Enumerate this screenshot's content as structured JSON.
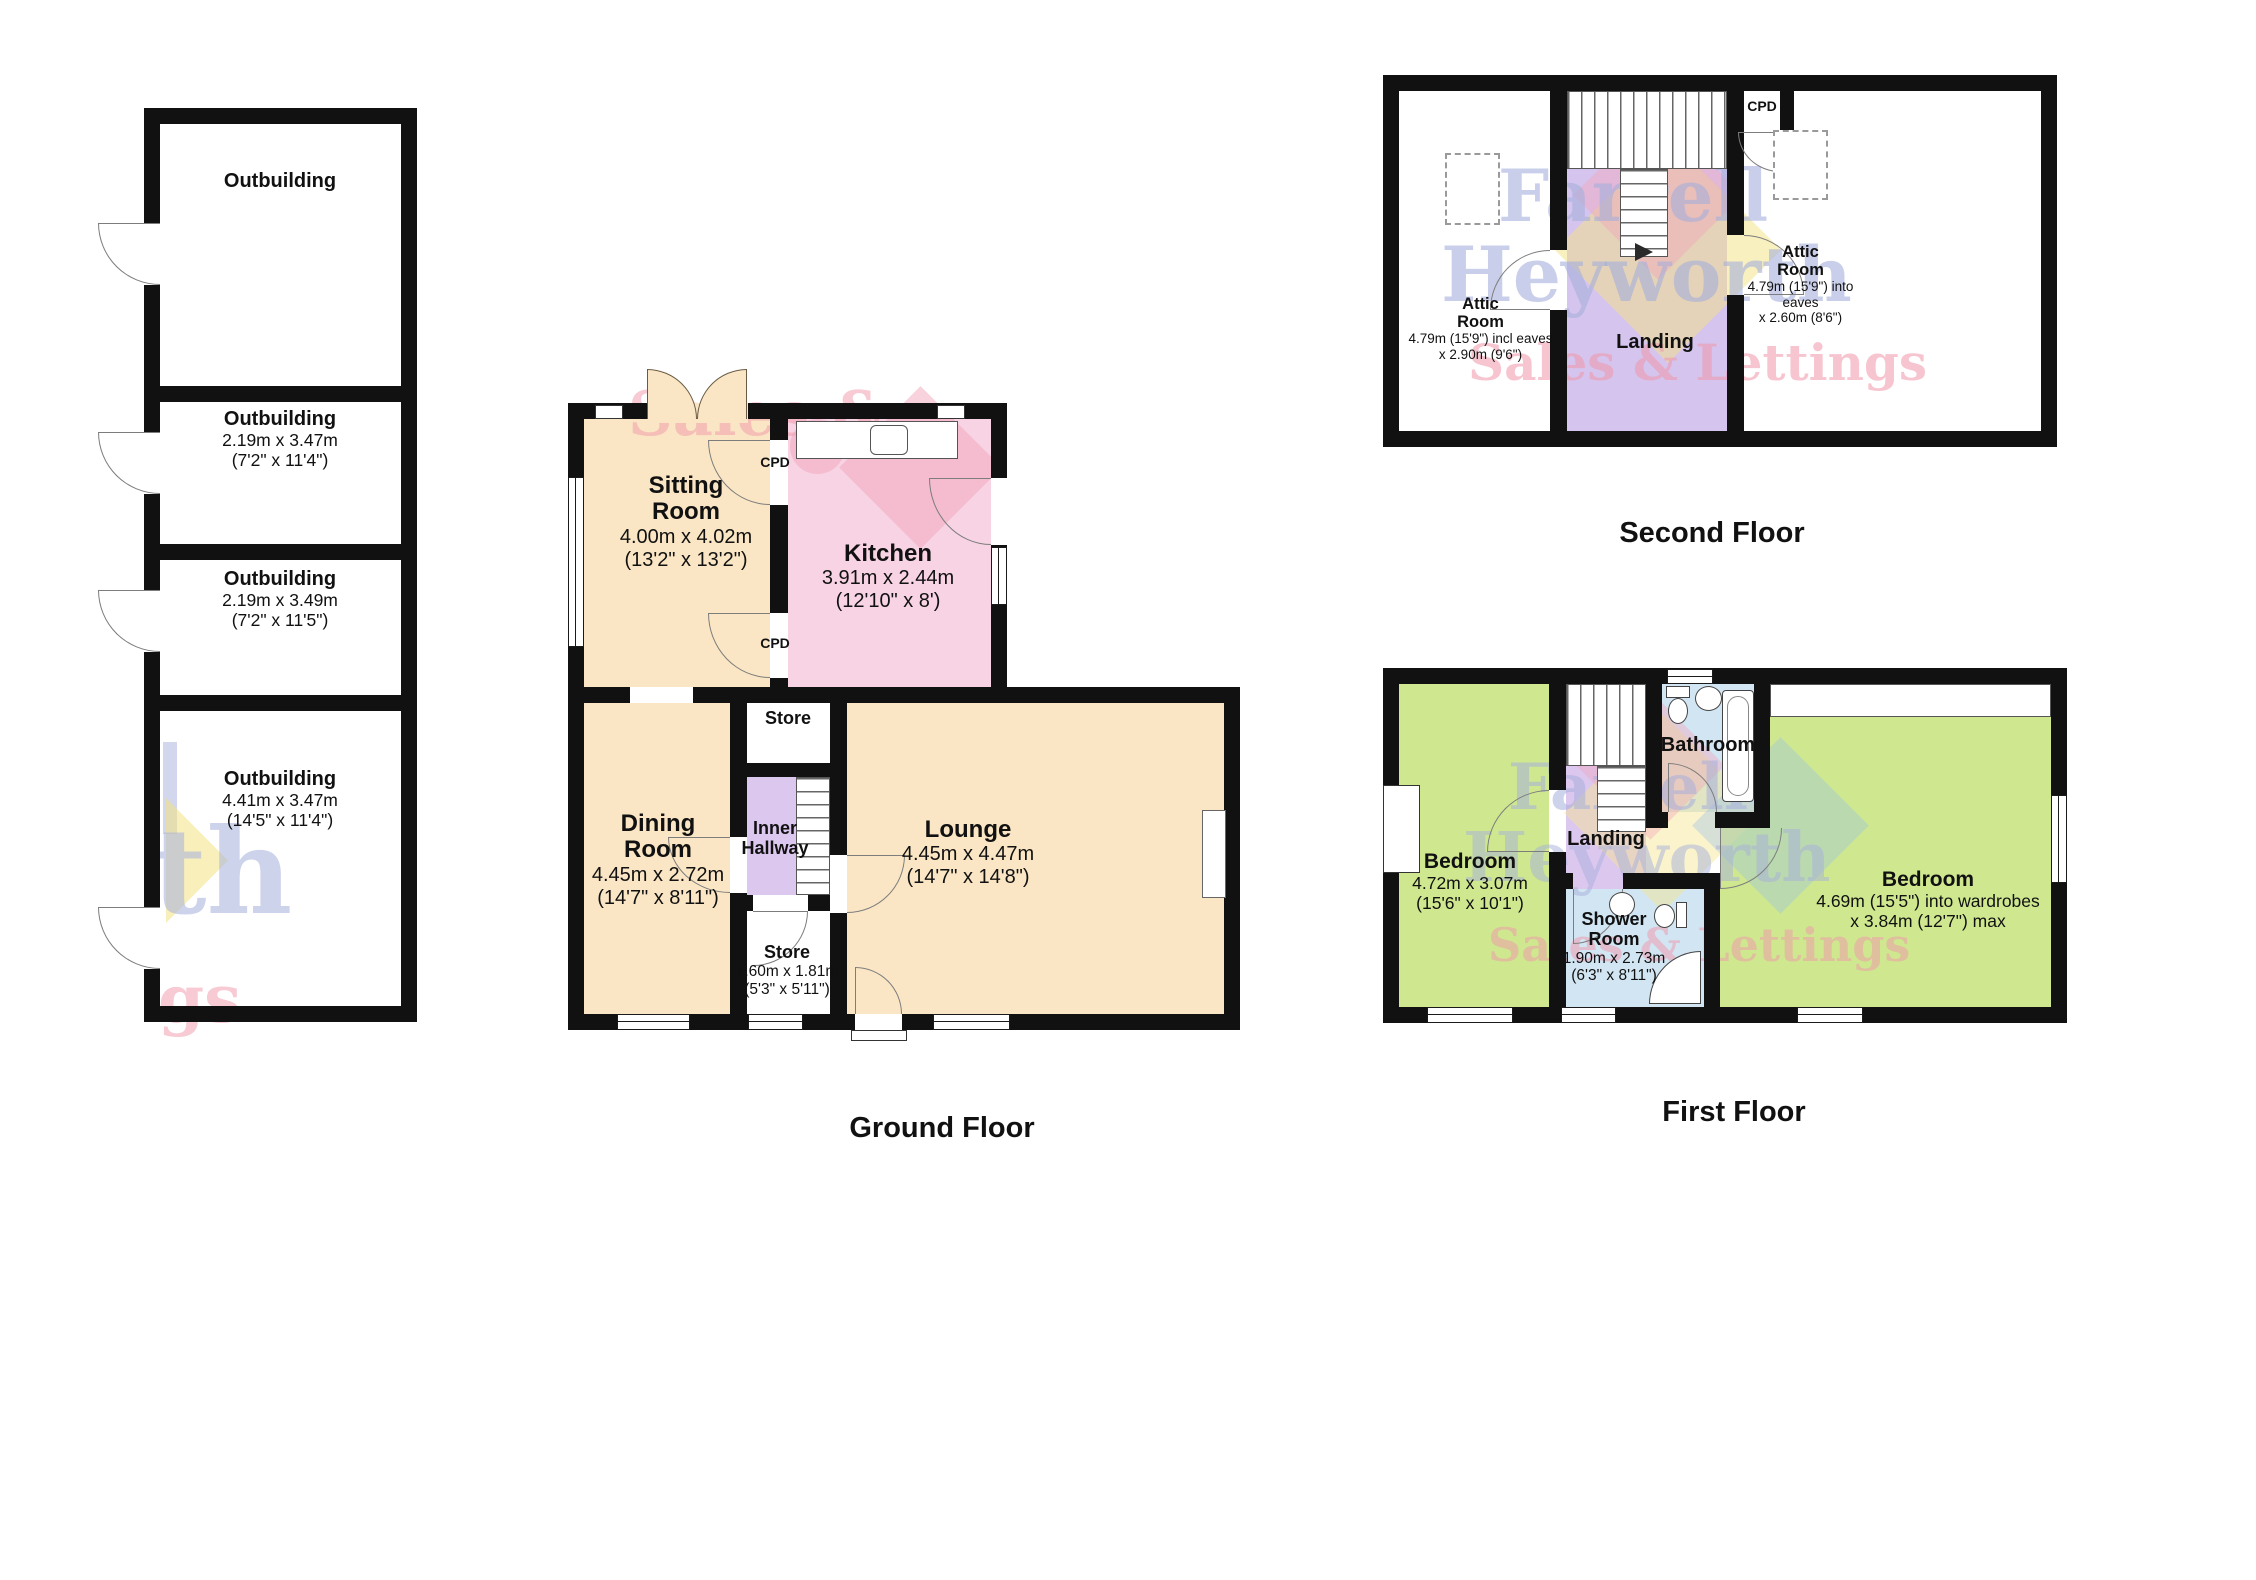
{
  "page": {
    "background": "#ffffff"
  },
  "titles": {
    "ground_floor": "Ground Floor",
    "first_floor": "First Floor",
    "second_floor": "Second Floor"
  },
  "watermark": {
    "farrell": "Farrell",
    "heyworth": "Heyworth",
    "sales_lettings": "Sales & Lettings",
    "frag_sales": "Sales &",
    "frag_th": "th",
    "frag_gs": "gs"
  },
  "colors": {
    "wall": "#111111",
    "room_peach": "#fae6c4",
    "room_pink": "#f7d3e3",
    "room_purple": "#dcc7ee",
    "room_green": "#cfe890",
    "room_blue": "#d2e5f2",
    "watermark_blue": "#a5afdc",
    "watermark_pink": "#f096aa",
    "watermark_yellow": "#f3e182"
  },
  "outbuildings": {
    "rooms": [
      {
        "name": "Outbuilding",
        "dims": ""
      },
      {
        "name": "Outbuilding",
        "dims": "2.19m x 3.47m\n(7'2\" x 11'4\")"
      },
      {
        "name": "Outbuilding",
        "dims": "2.19m x 3.49m\n(7'2\" x 11'5\")"
      },
      {
        "name": "Outbuilding",
        "dims": "4.41m x 3.47m\n(14'5\" x 11'4\")"
      }
    ]
  },
  "ground_floor": {
    "sitting_room": {
      "name": "Sitting\nRoom",
      "dims": "4.00m x 4.02m\n(13'2\" x 13'2\")"
    },
    "kitchen": {
      "name": "Kitchen",
      "dims": "3.91m x 2.44m\n(12'10\" x 8')"
    },
    "cpd_top": "CPD",
    "cpd_bottom": "CPD",
    "store_top": "Store",
    "inner_hallway": {
      "name": "Inner\nHallway"
    },
    "dining_room": {
      "name": "Dining\nRoom",
      "dims": "4.45m x 2.72m\n(14'7\" x 8'11\")"
    },
    "store_bottom": {
      "name": "Store",
      "dims": "1.60m x 1.81m\n(5'3\" x 5'11\")"
    },
    "lounge": {
      "name": "Lounge",
      "dims": "4.45m x 4.47m\n(14'7\" x 14'8\")"
    }
  },
  "second_floor": {
    "attic_left": {
      "name": "Attic\nRoom",
      "dims": "4.79m (15'9\") incl eaves\nx 2.90m (9'6\")"
    },
    "attic_right": {
      "name": "Attic\nRoom",
      "dims": "4.79m (15'9\") into eaves\nx 2.60m (8'6\")"
    },
    "landing": "Landing",
    "cpd": "CPD"
  },
  "first_floor": {
    "bedroom_left": {
      "name": "Bedroom",
      "dims": "4.72m x 3.07m\n(15'6\" x 10'1\")"
    },
    "bedroom_right": {
      "name": "Bedroom",
      "dims": "4.69m (15'5\") into wardrobes\nx 3.84m (12'7\") max"
    },
    "bathroom": "Bathroom",
    "landing": "Landing",
    "shower_room": {
      "name": "Shower\nRoom",
      "dims": "1.90m x 2.73m\n(6'3\" x 8'11\")"
    }
  }
}
